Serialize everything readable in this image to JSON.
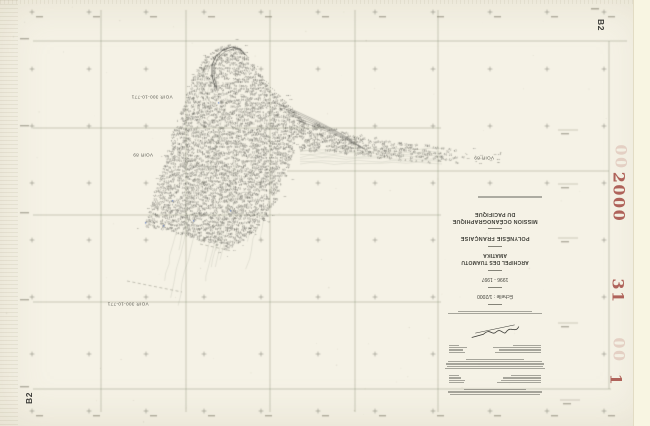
{
  "sheet": {
    "corner_label_top_right": "B2",
    "corner_label_bottom_left": "B2",
    "red_stamps": {
      "year": "2000",
      "number_31": "31",
      "number_1": "1",
      "ghost": "00",
      "color": "#a8534b"
    }
  },
  "map_labels": [
    {
      "text": "VOIR 300-10-771",
      "x": 152,
      "y": 97
    },
    {
      "text": "VOIR 89",
      "x": 143,
      "y": 155
    },
    {
      "text": "VOIR 89",
      "x": 484,
      "y": 158
    },
    {
      "text": "VOIR 300-10-771",
      "x": 128,
      "y": 304
    }
  ],
  "title_block": {
    "title_line1": "MISSION OCÉANOGRAPHIQUE",
    "title_line2": "DU PACIFIQUE",
    "region": "POLYNÉSIE FRANÇAISE",
    "archipelago": "ARCHIPEL DES TUAMOTU",
    "island": "AMATIKA",
    "years": "1996 - 1997",
    "scale": "Échelle : 1/2000",
    "fineprint": {
      "para_after_scale": [
        90,
        72
      ],
      "leader_a": [
        [
          46,
          16
        ],
        [
          42,
          14
        ],
        [
          48,
          18
        ],
        [
          28,
          10
        ]
      ],
      "para_large": [
        96,
        92,
        94,
        90,
        56
      ],
      "leader_b": [
        [
          44,
          15
        ],
        [
          40,
          16
        ],
        [
          38,
          12
        ],
        [
          30,
          10
        ]
      ],
      "para_top": [
        86,
        90,
        60
      ]
    }
  },
  "artwork": {
    "grid": {
      "v": [
        [
          101,
          10,
          412
        ],
        [
          186,
          10,
          412
        ],
        [
          270,
          10,
          412
        ],
        [
          355,
          10,
          412
        ],
        [
          438,
          10,
          412
        ],
        [
          609,
          41,
          389
        ]
      ],
      "h": [
        [
          41,
          33,
          627
        ],
        [
          128,
          33,
          441
        ],
        [
          215,
          33,
          441
        ],
        [
          302,
          33,
          441
        ],
        [
          389,
          33,
          611
        ],
        [
          171,
          287,
          609
        ]
      ],
      "cross_xs": [
        32,
        89,
        146,
        204,
        261,
        318,
        375,
        433,
        490,
        547,
        604
      ],
      "cross_ys": [
        12,
        69,
        126,
        183,
        240,
        297,
        354,
        411
      ],
      "rmarks": [
        [
          558,
          578,
          130
        ],
        [
          558,
          578,
          184
        ],
        [
          558,
          578,
          238
        ],
        [
          558,
          578,
          323
        ],
        [
          560,
          580,
          400
        ]
      ],
      "skip_rect": [
        438,
        205,
        556,
        400
      ]
    },
    "tex": {
      "blob": [
        [
          232,
          46
        ],
        [
          242,
          52
        ],
        [
          252,
          66
        ],
        [
          262,
          80
        ],
        [
          272,
          92
        ],
        [
          283,
          103
        ],
        [
          295,
          114
        ],
        [
          303,
          122
        ],
        [
          300,
          133
        ],
        [
          294,
          146
        ],
        [
          290,
          160
        ],
        [
          285,
          176
        ],
        [
          277,
          196
        ],
        [
          266,
          216
        ],
        [
          252,
          232
        ],
        [
          236,
          246
        ],
        [
          225,
          250
        ],
        [
          192,
          240
        ],
        [
          160,
          230
        ],
        [
          143,
          227
        ],
        [
          150,
          205
        ],
        [
          158,
          180
        ],
        [
          166,
          153
        ],
        [
          175,
          123
        ],
        [
          186,
          92
        ],
        [
          196,
          70
        ],
        [
          207,
          56
        ],
        [
          218,
          48
        ]
      ],
      "tail": [
        [
          298,
          120
        ],
        [
          330,
          130
        ],
        [
          365,
          138
        ],
        [
          400,
          143
        ],
        [
          440,
          148
        ],
        [
          468,
          152
        ],
        [
          468,
          164
        ],
        [
          430,
          163
        ],
        [
          395,
          161
        ],
        [
          360,
          157
        ],
        [
          330,
          153
        ],
        [
          298,
          152
        ]
      ],
      "tail_fade_from": 380,
      "tracks": [
        [
          278,
          104,
          352,
          140
        ],
        [
          283,
          108,
          356,
          143
        ],
        [
          288,
          112,
          360,
          146
        ],
        [
          292,
          116,
          363,
          148
        ],
        [
          296,
          120,
          366,
          150
        ]
      ],
      "hook": [
        [
          215,
          87
        ],
        [
          212,
          76
        ],
        [
          212,
          65
        ],
        [
          216,
          56
        ],
        [
          223,
          50
        ],
        [
          232,
          47
        ],
        [
          240,
          49
        ],
        [
          245,
          55
        ]
      ],
      "dotted_edge": [
        [
          252,
          66
        ],
        [
          258,
          73
        ],
        [
          264,
          80
        ],
        [
          270,
          87
        ],
        [
          276,
          93
        ],
        [
          282,
          99
        ],
        [
          288,
          105
        ],
        [
          294,
          111
        ],
        [
          299,
          117
        ]
      ],
      "ellipses": [
        [
          190,
          165,
          7,
          4
        ],
        [
          212,
          118,
          5,
          3
        ],
        [
          243,
          196,
          6,
          3.5
        ]
      ],
      "blue": [
        [
          145,
          222
        ],
        [
          163,
          225
        ],
        [
          193,
          220
        ],
        [
          218,
          102
        ],
        [
          230,
          210
        ],
        [
          172,
          200
        ]
      ],
      "dashes": [
        [
          127,
          281,
          182,
          292
        ],
        [
          200,
          244,
          232,
          251
        ]
      ],
      "tip_box": [
        462,
        500,
        149,
        167
      ]
    }
  }
}
